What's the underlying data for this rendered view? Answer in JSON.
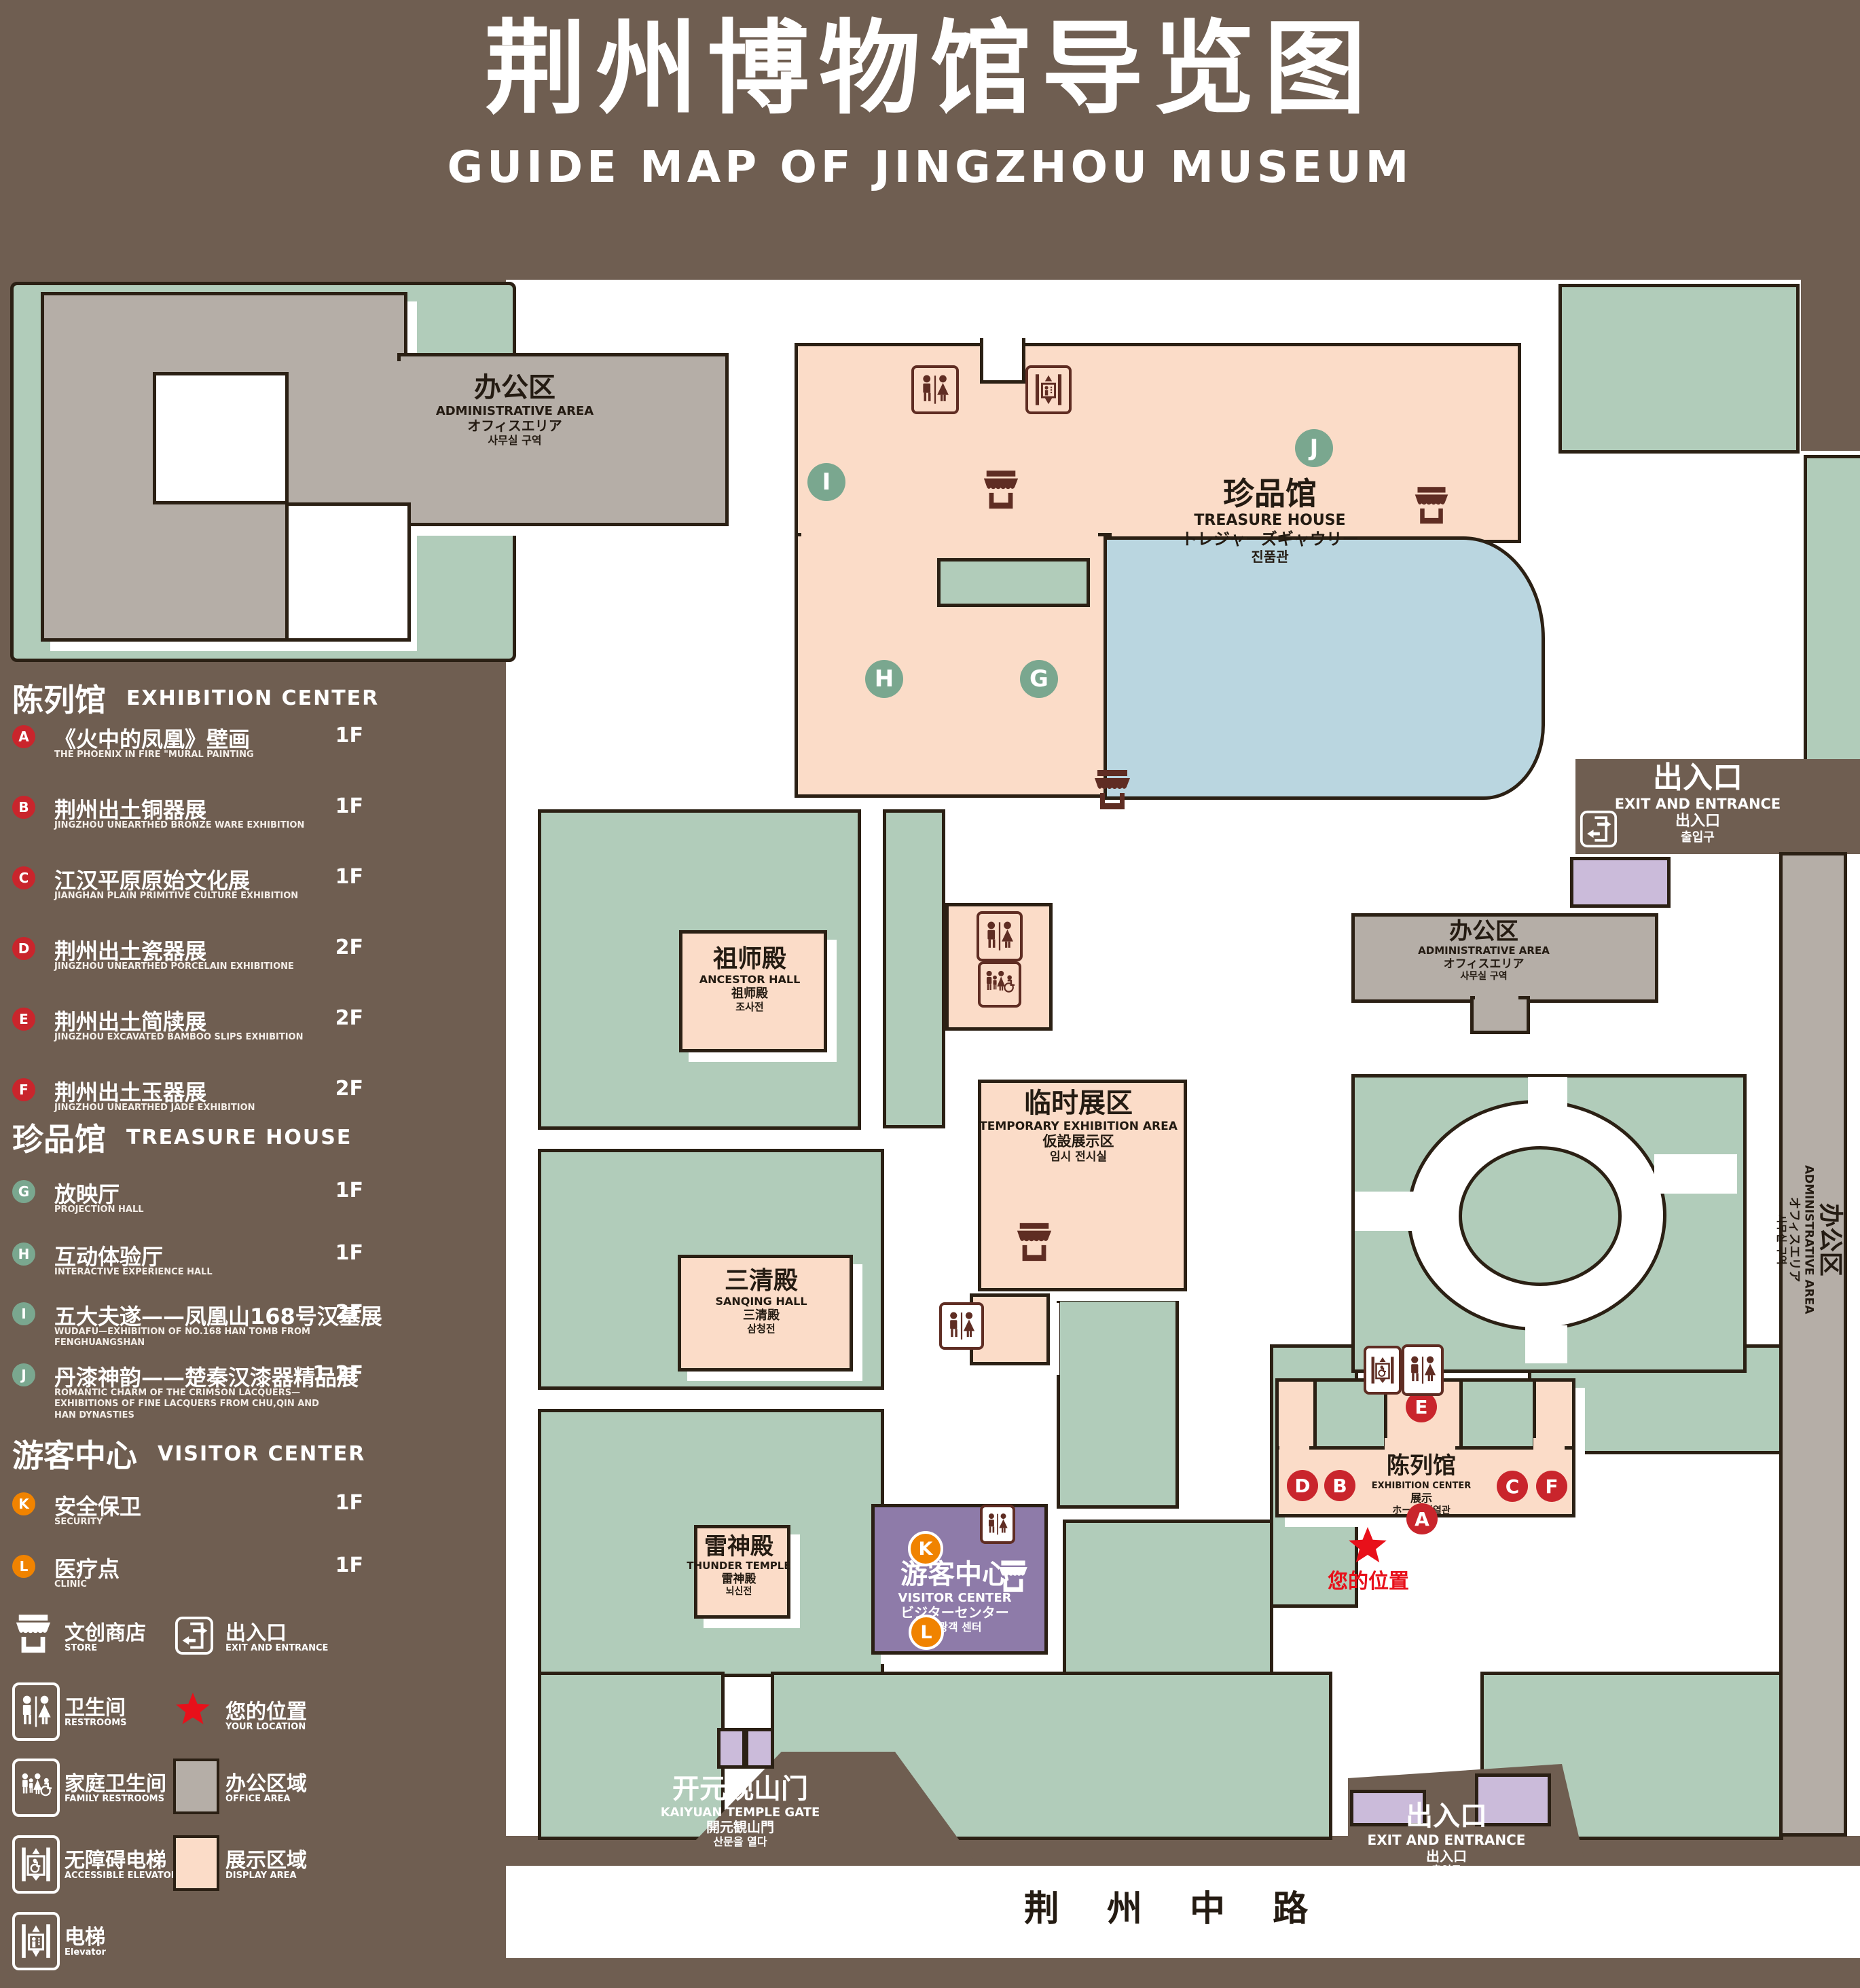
{
  "page_title": {
    "cn": "荆州博物馆导览图",
    "en": "GUIDE MAP OF JINGZHOU MUSEUM"
  },
  "colors": {
    "background": "#6F5E51",
    "lawn": "#B1CCBA",
    "display_area": "#FBDCC8",
    "office_area": "#B5AEA7",
    "water": "#BAD6E0",
    "visitor_center": "#8E7BA9",
    "gate_building": "#CBBBDA",
    "outline": "#2B2014",
    "marker_red": "#C9252C",
    "marker_green": "#7AA78F",
    "marker_orange": "#F08300",
    "icon_maroon": "#5F2D23",
    "location_red": "#E8101A"
  },
  "legend": {
    "sections": [
      {
        "title_cn": "陈列馆",
        "title_en": "EXHIBITION CENTER",
        "items": [
          {
            "letter": "A",
            "title": "《火中的凤凰》壁画",
            "subtitle": "THE PHOENIX IN FIRE \"MURAL PAINTING",
            "floor": "1F"
          },
          {
            "letter": "B",
            "title": "荆州出土铜器展",
            "subtitle": "JINGZHOU UNEARTHED BRONZE WARE EXHIBITION",
            "floor": "1F"
          },
          {
            "letter": "C",
            "title": "江汉平原原始文化展",
            "subtitle": "JIANGHAN PLAIN PRIMITIVE CULTURE EXHIBITION",
            "floor": "1F"
          },
          {
            "letter": "D",
            "title": "荆州出土瓷器展",
            "subtitle": "JINGZHOU UNEARTHED PORCELAIN EXHIBITIONE",
            "floor": "2F"
          },
          {
            "letter": "E",
            "title": "荆州出土简牍展",
            "subtitle": "JINGZHOU EXCAVATED BAMBOO SLIPS EXHIBITION",
            "floor": "2F"
          },
          {
            "letter": "F",
            "title": "荆州出土玉器展",
            "subtitle": "JINGZHOU UNEARTHED JADE EXHIBITION",
            "floor": "2F"
          }
        ]
      },
      {
        "title_cn": "珍品馆",
        "title_en": "TREASURE HOUSE",
        "items": [
          {
            "letter": "G",
            "title": "放映厅",
            "subtitle": "PROJECTION HALL",
            "floor": "1F"
          },
          {
            "letter": "H",
            "title": "互动体验厅",
            "subtitle": "INTERACTIVE EXPERIENCE HALL",
            "floor": "1F"
          },
          {
            "letter": "I",
            "title": "五大夫遂——凤凰山168号汉墓展",
            "subtitle": "WUDAFU—EXHIBITION OF NO.168 HAN TOMB FROM FENGHUANGSHAN",
            "floor": "2F"
          },
          {
            "letter": "J",
            "title": "丹漆神韵——楚秦汉漆器精品展",
            "subtitle": "ROMANTIC CHARM OF THE CRIMSON LACQUERS—EXHIBITIONS OF FINE LACQUERS FROM CHU,QIN AND HAN DYNASTIES",
            "floor": "1-2F"
          }
        ]
      },
      {
        "title_cn": "游客中心",
        "title_en": "VISITOR CENTER",
        "items": [
          {
            "letter": "K",
            "title": "安全保卫",
            "subtitle": "SECURITY",
            "floor": "1F"
          },
          {
            "letter": "L",
            "title": "医疗点",
            "subtitle": "CLINIC",
            "floor": "1F"
          }
        ]
      }
    ],
    "symbols": [
      {
        "icon": "store-icon",
        "cn": "文创商店",
        "en": "STORE"
      },
      {
        "icon": "exit-icon",
        "cn": "出入口",
        "en": "EXIT AND ENTRANCE"
      },
      {
        "icon": "restrooms-icon",
        "cn": "卫生间",
        "en": "RESTROOMS"
      },
      {
        "icon": "location-star-icon",
        "cn": "您的位置",
        "en": "YOUR LOCATION"
      },
      {
        "icon": "family-restrooms-icon",
        "cn": "家庭卫生间",
        "en": "FAMILY RESTROOMS"
      },
      {
        "icon": "office-area-swatch",
        "cn": "办公区域",
        "en": "OFFICE AREA"
      },
      {
        "icon": "accessible-elevator-icon",
        "cn": "无障碍电梯",
        "en": "ACCESSIBLE ELEVATOR"
      },
      {
        "icon": "display-area-swatch",
        "cn": "展示区域",
        "en": "DISPLAY AREA"
      },
      {
        "icon": "elevator-icon",
        "cn": "电梯",
        "en": "Elevator"
      }
    ]
  },
  "map": {
    "admin_area": {
      "cn": "办公区",
      "en": "ADMINISTRATIVE AREA",
      "jp": "オフィスエリア",
      "kr": "사무실 구역"
    },
    "treasure_house": {
      "cn": "珍品馆",
      "en": "TREASURE HOUSE",
      "jp": "トレジャーズギャウリー",
      "kr": "진품관",
      "markers": {
        "i": "I",
        "j": "J",
        "h": "H",
        "g": "G"
      }
    },
    "ancestor_hall": {
      "cn": "祖师殿",
      "en": "ANCESTOR HALL",
      "jp": "祖师殿",
      "kr": "조사전"
    },
    "temporary_area": {
      "cn": "临时展区",
      "en": "TEMPORARY EXHIBITION AREA",
      "jp": "仮設展示区",
      "kr": "임시 전시실"
    },
    "sanqing_hall": {
      "cn": "三清殿",
      "en": "SANQING HALL",
      "jp": "三清殿",
      "kr": "삼청전"
    },
    "thunder_temple": {
      "cn": "雷神殿",
      "en": "THUNDER TEMPLE",
      "jp": "雷神殿",
      "kr": "뇌신전"
    },
    "visitor_center": {
      "cn": "游客中心",
      "en": "VISITOR CENTER",
      "jp": "ビジターセンター",
      "kr": "관광객 센터",
      "markers": {
        "k": "K",
        "l": "L"
      }
    },
    "exhibition_center": {
      "cn": "陈列馆",
      "en": "EXHIBITION CENTER",
      "jp": "展示",
      "jp2": "ホール 진열관",
      "markers": {
        "a": "A",
        "b": "B",
        "c": "C",
        "d": "D",
        "e": "E",
        "f": "F"
      }
    },
    "exit_top": {
      "cn": "出入口",
      "en": "EXIT AND ENTRANCE",
      "jp": "出入口",
      "kr": "출입구"
    },
    "exit_bottom": {
      "cn": "出入口",
      "en": "EXIT AND ENTRANCE",
      "jp": "出入口",
      "kr": "출입구"
    },
    "kaiyuan_gate": {
      "cn": "开元观山门",
      "en": "KAIYUAN TEMPLE GATE",
      "jp": "開元観山門",
      "kr": "산문을 열다"
    },
    "your_location": "您的位置",
    "road": "荆 州 中 路"
  }
}
